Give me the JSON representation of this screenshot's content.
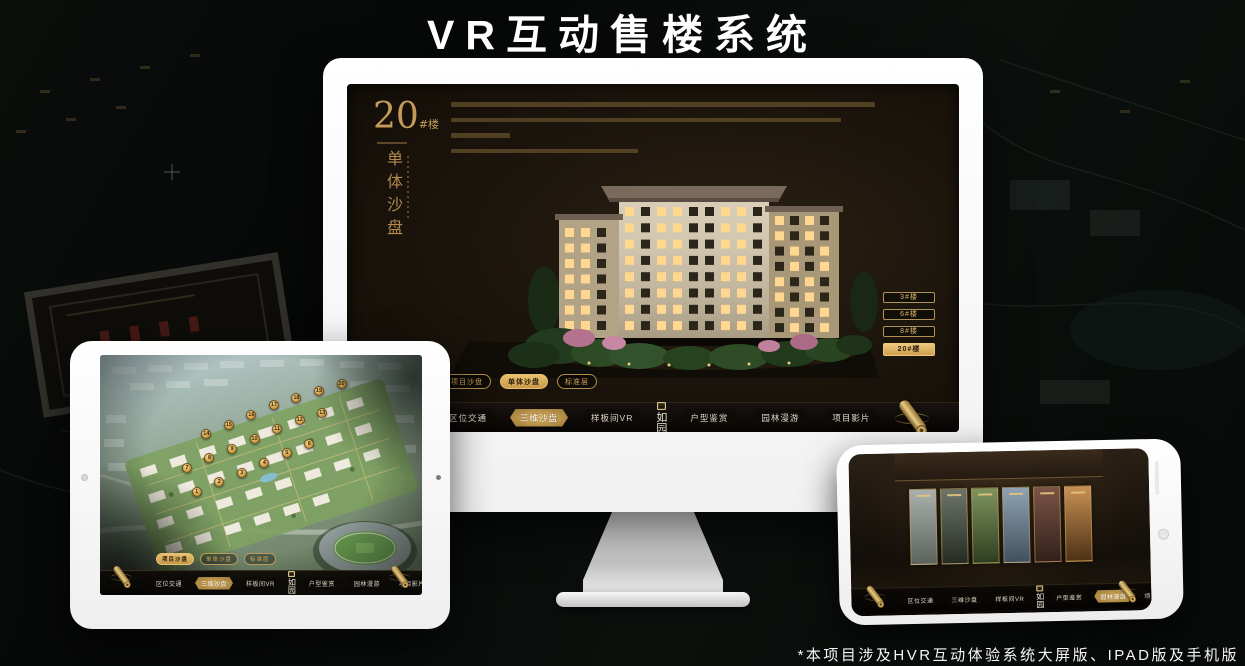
{
  "page": {
    "title": "VR互动售楼系统",
    "footnote": "*本项目涉及HVR互动体验系统大屏版、IPAD版及手机版"
  },
  "nav": {
    "logo": "如园",
    "items": [
      "区位交通",
      "三维沙盘",
      "样板间VR",
      "户型鉴赏",
      "园林漫游",
      "项目影片"
    ]
  },
  "tabs": [
    "项目沙盘",
    "单体沙盘",
    "标准层"
  ],
  "desktop_screen": {
    "headline_number": "20",
    "headline_suffix": "#楼",
    "headline_vertical": "单体沙盘",
    "building_buttons": [
      "3#楼",
      "6#楼",
      "8#楼",
      "20#楼"
    ],
    "active_building": "20#楼",
    "active_tab": "单体沙盘",
    "active_nav_item": "三维沙盘"
  },
  "tablet_screen": {
    "active_tab": "项目沙盘",
    "active_nav_item": "三维沙盘",
    "markers": [
      1,
      2,
      3,
      4,
      5,
      6,
      7,
      8,
      9,
      10,
      11,
      12,
      13,
      14,
      15,
      16,
      17,
      18,
      19,
      20
    ]
  },
  "phone_screen": {
    "active_nav_item": "园林漫游",
    "panels": [
      {
        "c1": "#aab0ac",
        "c2": "#5c625c"
      },
      {
        "c1": "#6d756a",
        "c2": "#262c24"
      },
      {
        "c1": "#7e9460",
        "c2": "#2f3d1e"
      },
      {
        "c1": "#8fa3b4",
        "c2": "#41505e"
      },
      {
        "c1": "#7a5446",
        "c2": "#33201a"
      },
      {
        "c1": "#c89055",
        "c2": "#4e3114"
      }
    ]
  },
  "colors": {
    "gold_accent": "#c9a05e",
    "gold_active": "#e0b86a",
    "screen_background": "#1c150c",
    "device_body": "#f7f7f7",
    "nav_text": "#ddd5c6",
    "title_text": "#ffffff"
  }
}
